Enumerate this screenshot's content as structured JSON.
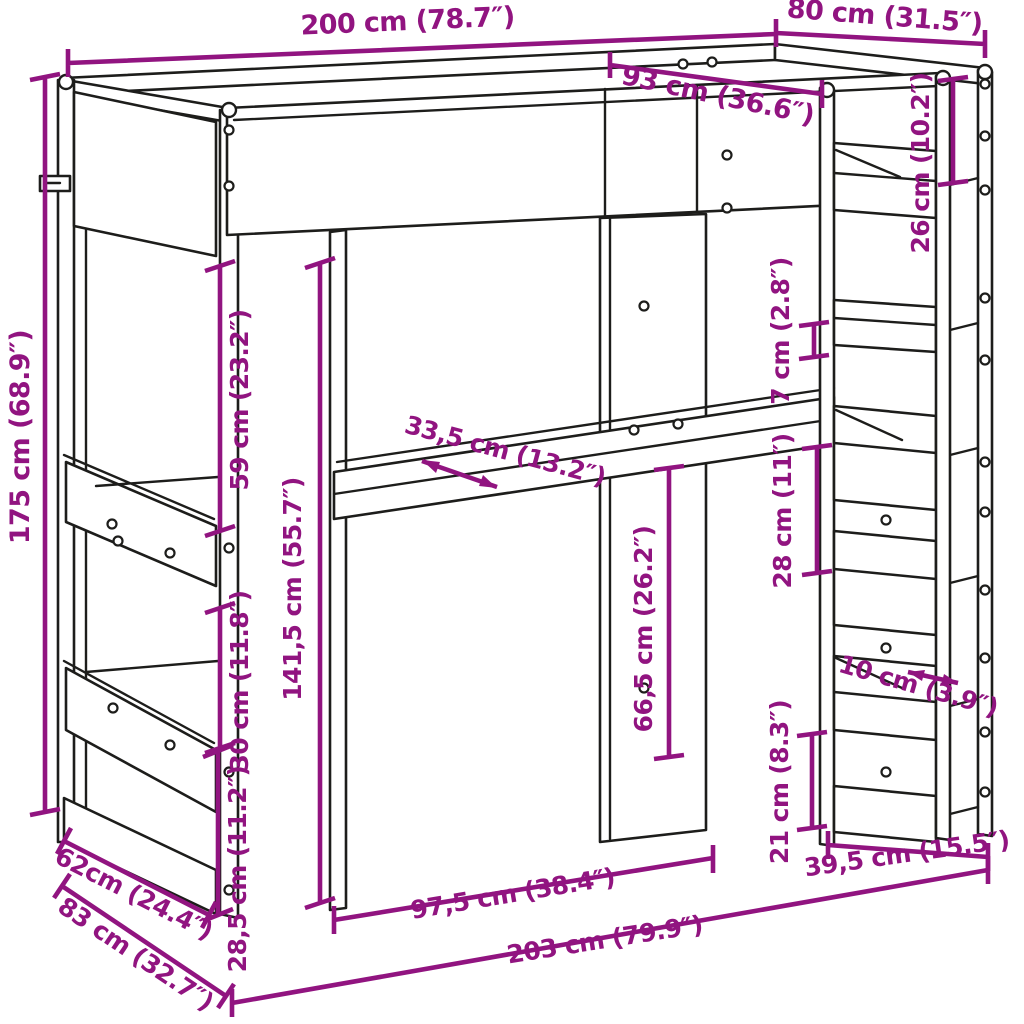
{
  "figure": {
    "kind": "product-dimension-diagram",
    "subject": "loft bed with desk, head-end shelving and shelf ladder tower",
    "background": "#ffffff"
  },
  "colors": {
    "dimension_accent": "#911480",
    "drawing_line": "#1d1d1b"
  },
  "units": {
    "primary": "cm",
    "secondary": "inches (in parentheses)"
  },
  "dimensions": [
    {
      "id": "top-length",
      "label": "200 cm (78.7″)",
      "cm": 200,
      "inches": 78.7
    },
    {
      "id": "top-depth",
      "label": "80 cm (31.5″)",
      "cm": 80,
      "inches": 31.5
    },
    {
      "id": "inner-depth",
      "label": "93 cm (36.6″)",
      "cm": 93,
      "inches": 36.6
    },
    {
      "id": "tower-top-gap",
      "label": "26 cm (10.2″)",
      "cm": 26,
      "inches": 10.2
    },
    {
      "id": "total-height",
      "label": "175 cm (68.9″)",
      "cm": 175,
      "inches": 68.9
    },
    {
      "id": "rail-to-shelf",
      "label": "59 cm (23.2″)",
      "cm": 59,
      "inches": 23.2
    },
    {
      "id": "clearance-height",
      "label": "141,5 cm (55.7″)",
      "cm": 141.5,
      "inches": 55.7
    },
    {
      "id": "desk-depth",
      "label": "33,5 cm (13.2″)",
      "cm": 33.5,
      "inches": 13.2
    },
    {
      "id": "rung-thickness",
      "label": "7 cm (2.8″)",
      "cm": 7,
      "inches": 2.8
    },
    {
      "id": "shelf-spacing-mid",
      "label": "28 cm (11″)",
      "cm": 28,
      "inches": 11
    },
    {
      "id": "desk-to-bottom",
      "label": "66,5 cm (26.2″)",
      "cm": 66.5,
      "inches": 26.2
    },
    {
      "id": "shelf-spacing-left",
      "label": "30 cm (11.8″)",
      "cm": 30,
      "inches": 11.8
    },
    {
      "id": "bottom-spacing-left",
      "label": "28,5 cm (11.2″)",
      "cm": 28.5,
      "inches": 11.2
    },
    {
      "id": "side-depth-upper",
      "label": "62cm (24.4″)",
      "cm": 62,
      "inches": 24.4
    },
    {
      "id": "side-depth-floor",
      "label": "83 cm (32.7″)",
      "cm": 83,
      "inches": 32.7
    },
    {
      "id": "desk-opening-width",
      "label": "97,5 cm (38.4″)",
      "cm": 97.5,
      "inches": 38.4
    },
    {
      "id": "total-floor-length",
      "label": "203 cm (79.9″)",
      "cm": 203,
      "inches": 79.9
    },
    {
      "id": "tower-width",
      "label": "39,5 cm (15.5″)",
      "cm": 39.5,
      "inches": 15.5
    },
    {
      "id": "tower-bottom-gap",
      "label": "21 cm (8.3″)",
      "cm": 21,
      "inches": 8.3
    },
    {
      "id": "shelf-depth",
      "label": "10 cm (3.9″)",
      "cm": 10,
      "inches": 3.9
    }
  ]
}
